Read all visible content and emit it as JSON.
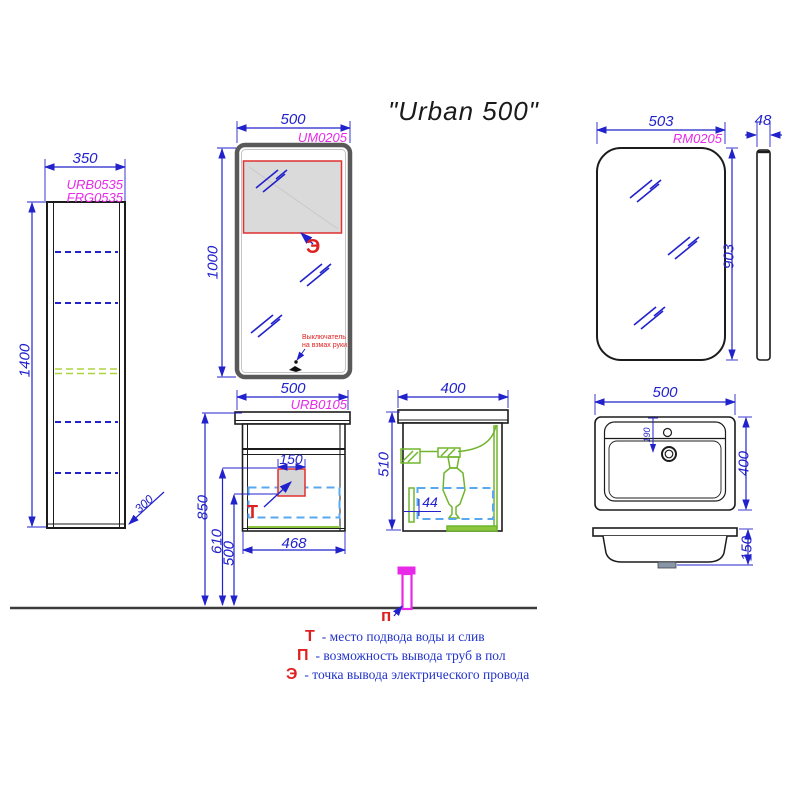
{
  "title": "\"Urban 500\"",
  "tall_cabinet": {
    "code_top": "URB0535",
    "code_bottom": "FRG0535",
    "width": "350",
    "height": "1400",
    "bottom_offset": "300"
  },
  "mirror_front": {
    "code": "UM0205",
    "width": "500",
    "height": "1000",
    "electric_marker": "Э",
    "switch_note_line1": "Выключатель",
    "switch_note_line2": "на взмах руки"
  },
  "mirror_right": {
    "code": "RM0205",
    "width": "503",
    "height": "903",
    "depth": "48"
  },
  "vanity_front": {
    "code": "URB0105",
    "width": "500",
    "body_width": "468",
    "cutout_width": "150",
    "height_top": "850",
    "height_mid": "610",
    "height_low": "500",
    "water_marker": "Т"
  },
  "vanity_side": {
    "depth": "400",
    "height": "510",
    "pipe_offset": "44"
  },
  "sink_top": {
    "width": "500",
    "depth": "400",
    "drain_offset": "190"
  },
  "sink_side": {
    "height": "150"
  },
  "floor_pipe": {
    "marker": "п"
  },
  "legend": [
    {
      "key": "Т",
      "text": "- место подвода воды и слив"
    },
    {
      "key": "П",
      "text": "- возможность вывода труб в пол"
    },
    {
      "key": "Э",
      "text": "- точка вывода электрического провода"
    }
  ],
  "colors": {
    "dimension_blue": "#2222cc",
    "code_magenta": "#e82ae8",
    "marker_red": "#e02020",
    "hardware_green": "#70b52c",
    "drawer_dash_blue": "#58a8f0",
    "shelf_dash_green": "#aed240",
    "pipe_magenta": "#e82ae8"
  }
}
